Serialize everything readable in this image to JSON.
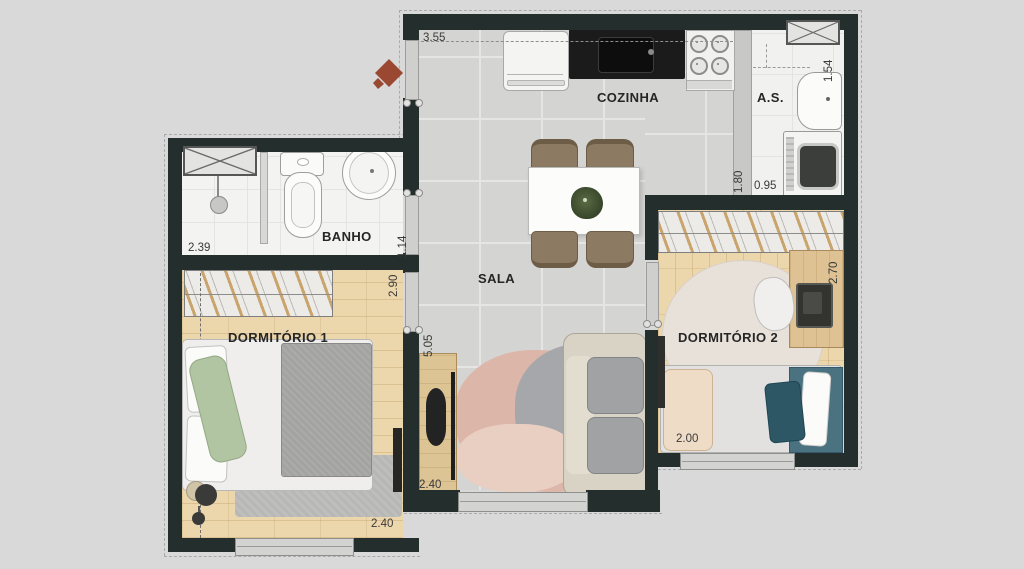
{
  "plan": {
    "rooms": {
      "cozinha": {
        "label": "COZINHA",
        "width_dim": "3.55"
      },
      "servico": {
        "label": "A.S.",
        "width_dim": "1.54",
        "depth_dim": "1.80",
        "inner_width_dim": "0.95"
      },
      "banho": {
        "label": "BANHO",
        "width_dim": "2.39",
        "depth_dim": "1.14"
      },
      "sala": {
        "label": "SALA",
        "length_dim": "5.05",
        "width_dim": "2.40"
      },
      "dormitorio1": {
        "label": "DORMITÓRIO 1",
        "depth_dim": "2.90",
        "width_dim": "2.40"
      },
      "dormitorio2": {
        "label": "DORMITÓRIO 2",
        "depth_dim": "2.70",
        "width_dim": "2.00"
      }
    },
    "colors": {
      "wall": "#242e2c",
      "tile_floor": "#d4d4d2",
      "wood_floor": "#ecd6ab",
      "background": "#d9d9d9",
      "entry_arrow": "#9a4832",
      "accent_teal": "#2e5766"
    }
  }
}
